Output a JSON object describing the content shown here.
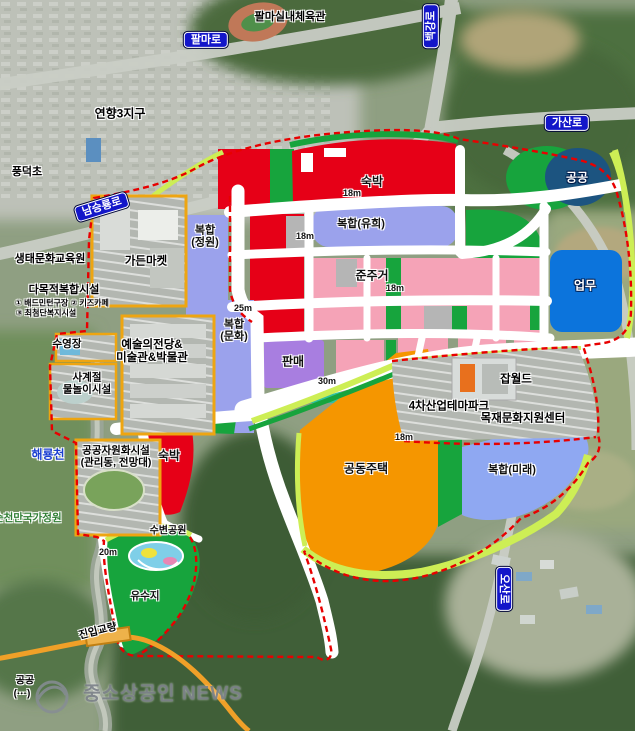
{
  "colors": {
    "lodging_red": "#e60017",
    "mixed_periwinkle": "#9ba2ec",
    "mixed_future_blue": "#8fa8f2",
    "green_zone": "#17a43d",
    "public_navy": "#1c5480",
    "business_blue": "#0c74dc",
    "semi_residential_pink": "#f5a3b7",
    "retail_purple": "#a87ee0",
    "apartment_orange": "#f59600",
    "buffer_lime": "#cdee55",
    "teal_strip": "#2fc0a0",
    "gray_block": "#b5b5b5",
    "road_white": "#ffffff",
    "boundary_red": "#e80000",
    "parcel_orange": "#eea511",
    "sign_blue": "#1316c9",
    "orange_road": "#f0a028"
  },
  "map": {
    "labels": [
      {
        "name": "sign-palma-ro",
        "type": "sign",
        "text": "팔마로",
        "x": 206,
        "y": 40
      },
      {
        "name": "sign-baekgang-ro",
        "type": "sign",
        "text": "백강로",
        "x": 431,
        "y": 26,
        "rot": -90
      },
      {
        "name": "sign-gasan-ro",
        "type": "sign",
        "text": "가산로",
        "x": 567,
        "y": 123
      },
      {
        "name": "sign-namseungnyong-ro",
        "type": "sign",
        "text": "남승룡로",
        "x": 102,
        "y": 207,
        "rot": -17
      },
      {
        "name": "sign-osan-ro",
        "type": "sign",
        "text": "오산로",
        "x": 504,
        "y": 589,
        "rot": 90
      },
      {
        "name": "place-palma-gym",
        "type": "fac halo",
        "text": "팔마실내체육관",
        "x": 290,
        "y": 17
      },
      {
        "name": "place-yeonhyang-district",
        "type": "fac halo",
        "text": "연향3지구",
        "x": 120,
        "y": 114,
        "size": 12
      },
      {
        "name": "place-pungdeok-elem",
        "type": "fac halo",
        "text": "풍덕초",
        "x": 27,
        "y": 172
      },
      {
        "name": "zone-label-sukbak-top",
        "type": "zone halo",
        "text": "숙박",
        "x": 372,
        "y": 182
      },
      {
        "name": "zone-label-gonggong",
        "type": "zone-light",
        "text": "공공",
        "x": 577,
        "y": 178
      },
      {
        "name": "zone-label-bokhap-yuhi",
        "type": "zone halo",
        "text": "복합(유희)",
        "x": 361,
        "y": 224,
        "size": 11
      },
      {
        "name": "zone-label-bokhap-jeongwon",
        "type": "zone halo",
        "text": "복합\n(정원)",
        "x": 205,
        "y": 237,
        "size": 11
      },
      {
        "name": "zone-label-junjugeo",
        "type": "zone halo",
        "text": "준주거",
        "x": 372,
        "y": 276
      },
      {
        "name": "zone-label-eopmu",
        "type": "zone-light",
        "text": "업무",
        "x": 585,
        "y": 286
      },
      {
        "name": "zone-label-bokhap-munhwa",
        "type": "zone halo",
        "text": "복합\n(문화)",
        "x": 234,
        "y": 331,
        "size": 11
      },
      {
        "name": "zone-label-panmae",
        "type": "zone halo",
        "text": "판매",
        "x": 293,
        "y": 362
      },
      {
        "name": "zone-label-gongdong-jutaek",
        "type": "zone halo",
        "text": "공동주택",
        "x": 366,
        "y": 469
      },
      {
        "name": "zone-label-bokhap-mirae",
        "type": "zone halo",
        "text": "복합(미래)",
        "x": 512,
        "y": 470,
        "size": 11
      },
      {
        "name": "zone-label-sukbak-sw",
        "type": "zone halo",
        "text": "숙박",
        "x": 169,
        "y": 456
      },
      {
        "name": "zone-label-subyeon-park",
        "type": "zone halo",
        "text": "수변공원",
        "x": 168,
        "y": 531,
        "size": 10
      },
      {
        "name": "zone-label-yusuji",
        "type": "zone halo",
        "text": "유수지",
        "x": 145,
        "y": 597,
        "size": 10.5
      },
      {
        "name": "fac-ecology-center",
        "type": "fac halo",
        "text": "생태문화교육원",
        "x": 50,
        "y": 259
      },
      {
        "name": "fac-multipurpose",
        "type": "fac halo",
        "text": "다목적복합시설",
        "x": 64,
        "y": 290
      },
      {
        "name": "fac-multipurpose-note-1",
        "type": "fac-sm halo",
        "text": "① 배드민턴구장  ② 키즈카페",
        "x": 62,
        "y": 304
      },
      {
        "name": "fac-multipurpose-note-2",
        "type": "fac-sm halo",
        "text": "③ 최첨단복지시설",
        "x": 46,
        "y": 314
      },
      {
        "name": "fac-garden-market",
        "type": "fac halo",
        "text": "가든마켓",
        "x": 146,
        "y": 262,
        "size": 11.5
      },
      {
        "name": "fac-swimming-pool",
        "type": "fac halo",
        "text": "수영장",
        "x": 67,
        "y": 345,
        "size": 10.5
      },
      {
        "name": "fac-water-play",
        "type": "fac halo",
        "text": "사계절\n물놀이시설",
        "x": 87,
        "y": 384,
        "size": 10.5
      },
      {
        "name": "fac-public-resource",
        "type": "fac halo",
        "text": "공공자원화시설\n(관리동, 전망대)",
        "x": 116,
        "y": 457,
        "size": 10.5
      },
      {
        "name": "fac-arts-center",
        "type": "fac halo",
        "text": "예술의전당&\n미술관&박물관",
        "x": 152,
        "y": 352,
        "size": 11.5
      },
      {
        "name": "fac-job-world",
        "type": "fac halo",
        "text": "잡월드",
        "x": 516,
        "y": 380,
        "size": 11.5
      },
      {
        "name": "fac-industry-park",
        "type": "fac halo",
        "text": "4차산업테마파크",
        "x": 449,
        "y": 407,
        "size": 11.5
      },
      {
        "name": "fac-wood-center",
        "type": "fac halo",
        "text": "목재문화지원센터",
        "x": 523,
        "y": 419,
        "size": 11.5
      },
      {
        "name": "fac-entry-bridge",
        "type": "fac halo",
        "text": "진입교량",
        "x": 98,
        "y": 632,
        "rot": -14,
        "size": 10.5
      },
      {
        "name": "river-haeryongcheon",
        "type": "river halo",
        "text": "해룡천",
        "x": 48,
        "y": 455
      },
      {
        "name": "park-suncheonman-garden",
        "type": "park halo",
        "text": "순천만국가정원",
        "x": -6,
        "y": 519,
        "anchor": "left"
      },
      {
        "name": "width-18m-1",
        "type": "wm halo",
        "text": "18m",
        "x": 352,
        "y": 193
      },
      {
        "name": "width-18m-2",
        "type": "wm halo",
        "text": "18m",
        "x": 305,
        "y": 236
      },
      {
        "name": "width-18m-3",
        "type": "wm halo",
        "text": "18m",
        "x": 395,
        "y": 288
      },
      {
        "name": "width-25m",
        "type": "wm halo",
        "text": "25m",
        "x": 243,
        "y": 308
      },
      {
        "name": "width-30m",
        "type": "wm halo",
        "text": "30m",
        "x": 327,
        "y": 381
      },
      {
        "name": "width-18m-4",
        "type": "wm halo",
        "text": "18m",
        "x": 404,
        "y": 437
      },
      {
        "name": "width-20m",
        "type": "wm halo",
        "text": "20m",
        "x": 108,
        "y": 552
      },
      {
        "name": "text-gonggong-partial",
        "type": "fac halo",
        "text": "공공",
        "x": 25,
        "y": 681,
        "size": 10
      },
      {
        "name": "text-paren-partial",
        "type": "fac halo",
        "text": "(···)",
        "x": 22,
        "y": 694,
        "size": 10
      },
      {
        "name": "watermark-text",
        "type": "watermark",
        "text": "중소상공인 NEWS",
        "x": 163,
        "y": 694
      }
    ]
  }
}
